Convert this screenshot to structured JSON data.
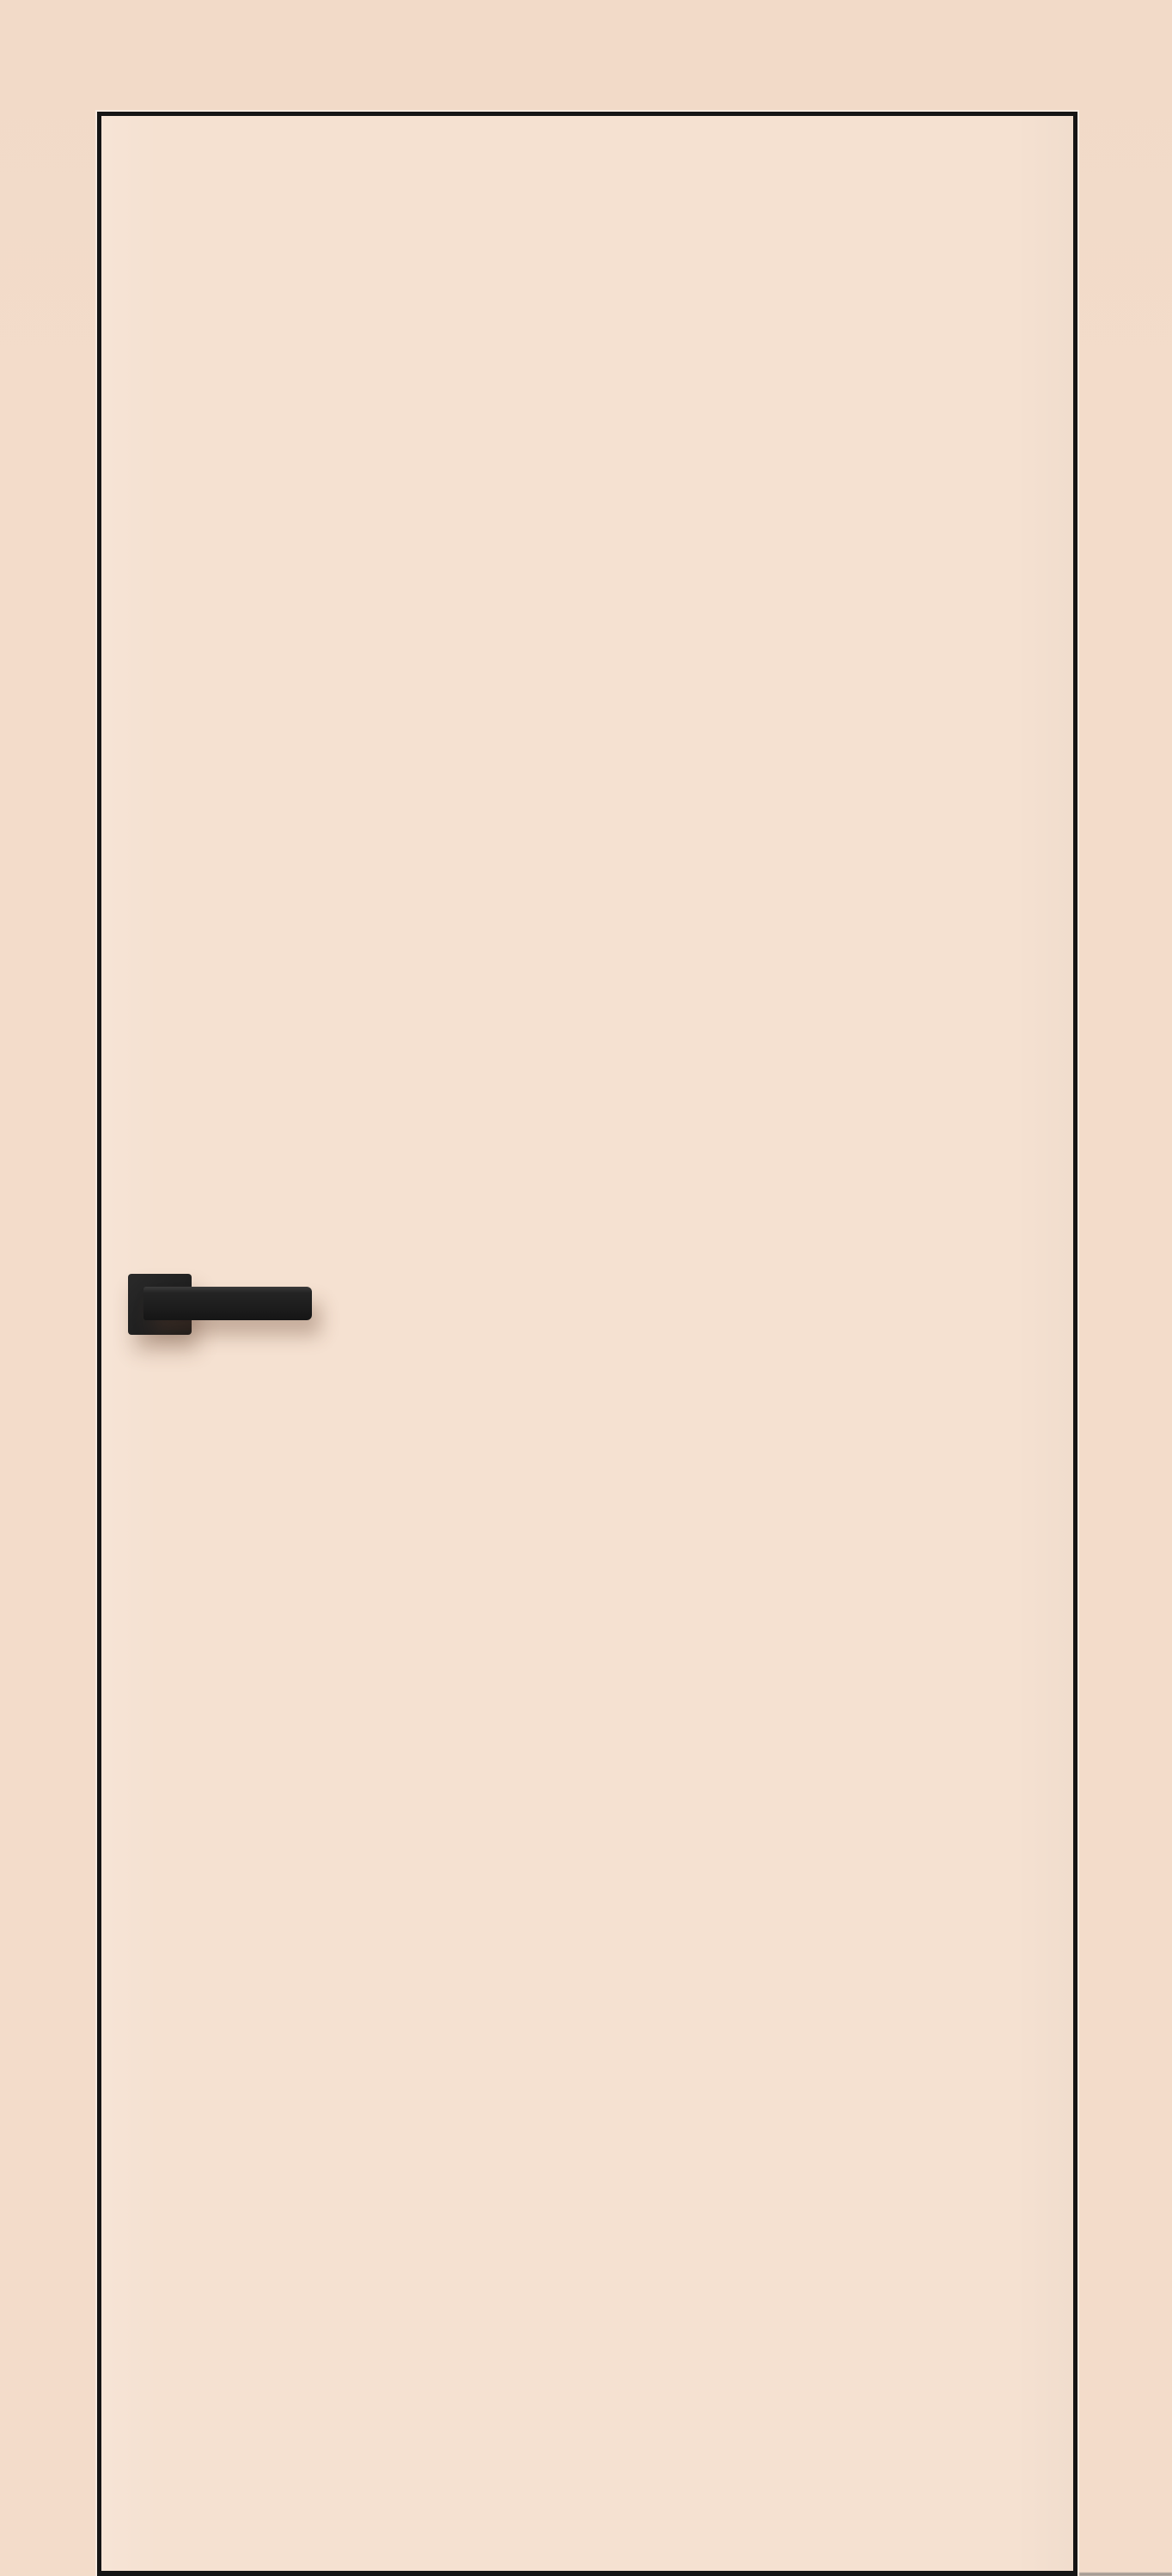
{
  "scene": {
    "kind": "interior-door-product-photo",
    "objects": {
      "wall": "plain peach wall",
      "door": "flush concealed-frame door leaf with thin black edge trim",
      "handle": "black square-rosette lever handle on left side of door",
      "floor_shadow": "faint gray floor shadow strip at bottom right of door"
    }
  },
  "colors": {
    "wall": "#f3dcca",
    "wall_top": "#f2dac8",
    "door_panel": "#f5e1d1",
    "door_edge": "#151515",
    "edge_highlight": "rgba(255,255,255,0.45)",
    "handle_dark": "#1d1d1d",
    "handle_mid": "#242424",
    "handle_light": "#3b3b3b",
    "handle_shadow": "rgba(95,63,45,0.32)",
    "floor_shadow": "#99938c"
  }
}
